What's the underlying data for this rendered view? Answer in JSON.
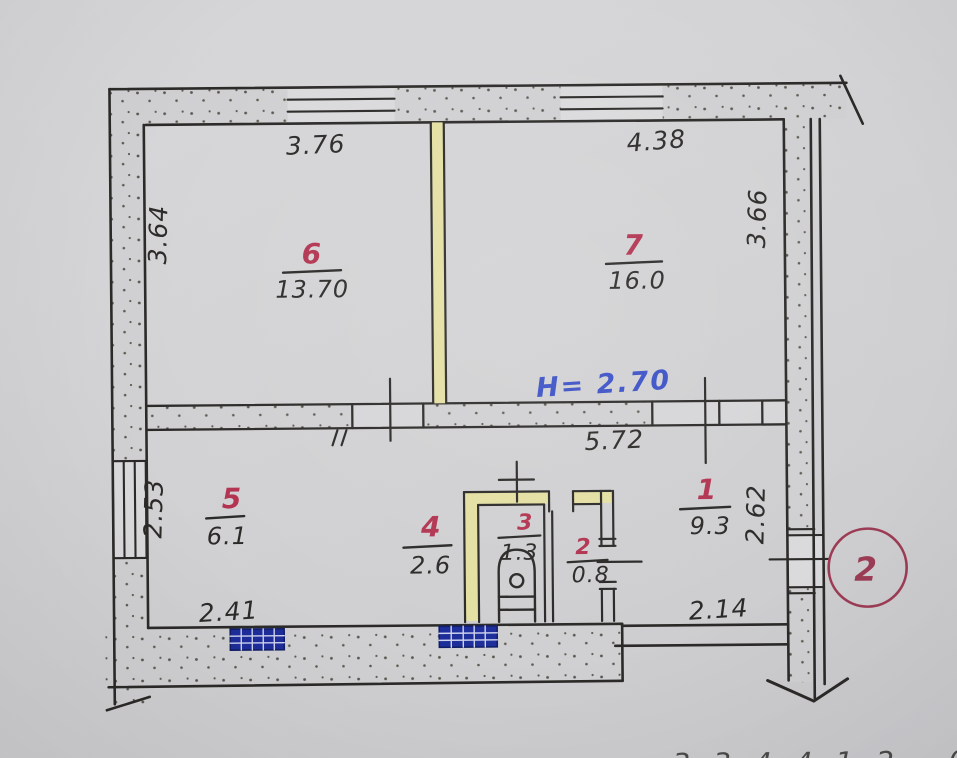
{
  "plan": {
    "rooms": [
      {
        "number": "6",
        "area": "13.70"
      },
      {
        "number": "7",
        "area": "16.0"
      },
      {
        "number": "5",
        "area": "6.1"
      },
      {
        "number": "4",
        "area": "2.6"
      },
      {
        "number": "3",
        "area": "1.3"
      },
      {
        "number": "2",
        "area": "0.8"
      },
      {
        "number": "1",
        "area": "9.3"
      }
    ],
    "dimensions": {
      "room6_width": "3.76",
      "room7_width": "4.38",
      "room6_depth": "3.64",
      "room7_depth": "3.66",
      "hall_width": "5.72",
      "room5_depth": "2.53",
      "room1_depth": "2.62",
      "room5_width": "2.41",
      "room1_width": "2.14"
    },
    "height_note": "H= 2.70",
    "sheet_marker": "2",
    "edge_text": "3 3 4 4 1 2 · 0 7"
  },
  "colors": {
    "paper": "#d2d2d4",
    "ink": "#2b2a28",
    "room_number_red": "#b23350",
    "height_blue": "#3a50c6",
    "radiator_navy": "#1d2d9a",
    "highlight_yellow": "#e4dfa2",
    "marker_maroon": "#9c3c55"
  }
}
